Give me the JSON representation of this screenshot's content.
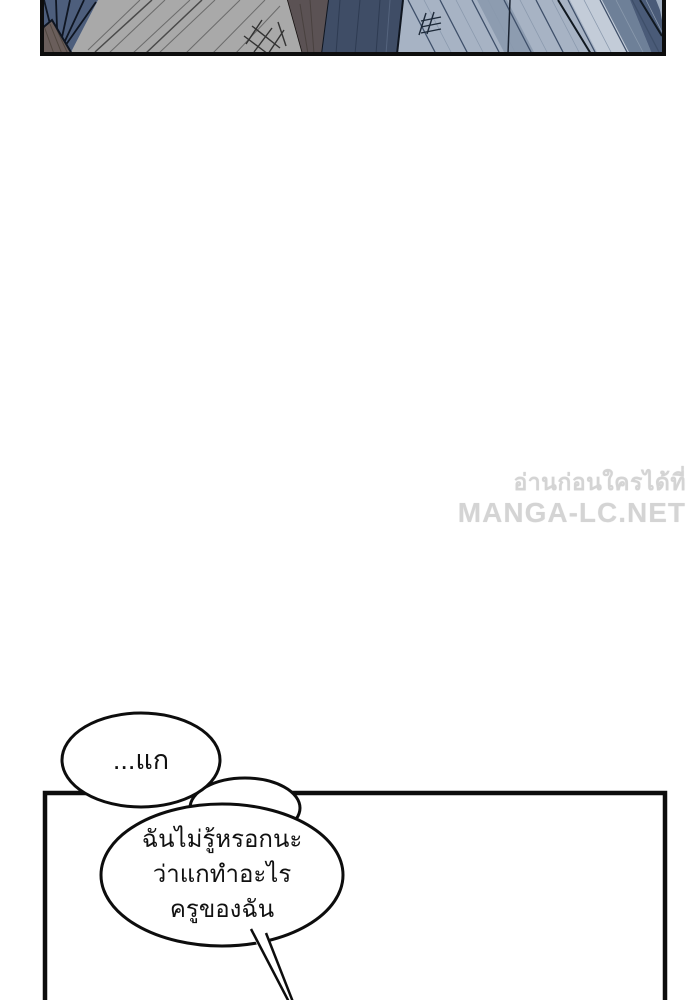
{
  "page": {
    "width": 700,
    "height": 1000,
    "background": "#ffffff"
  },
  "top_panel": {
    "description": "cropped abstract manga action panel with radiating speed lines",
    "border_color": "#0d0d0d",
    "colors": {
      "fan_blue": "#4d5e7c",
      "taupe_dark": "#6a5e5b",
      "gray_surface": "#a9a9a9",
      "taupe_wedge": "#5b5254",
      "navy_band": "#3f4d66",
      "light_blue": "#a7b3c4",
      "shadow_blue": "#8d9cb0",
      "bright_blue": "#c3ccd8",
      "slate_band": "#6e8098",
      "right_navy": "#4a5b78",
      "speed_line_dark": "#3e4f69",
      "speed_line_soft": "#8a99ad"
    }
  },
  "watermark": {
    "line1": "อ่านก่อนใครได้ที่",
    "line2": "MANGA-LC.NET",
    "color": "#d4d4d4"
  },
  "dialogue": {
    "bubble1": {
      "text": "...แก"
    },
    "bubble2": {
      "line1": "ฉันไม่รู้หรอกนะ",
      "line2": "ว่าแกทำอะไร",
      "line3": "ครูของฉัน"
    },
    "text_color": "#111111",
    "bubble_fill": "#ffffff",
    "bubble_stroke": "#0d0d0d"
  },
  "bottom_panel": {
    "border_color": "#0d0d0d"
  }
}
